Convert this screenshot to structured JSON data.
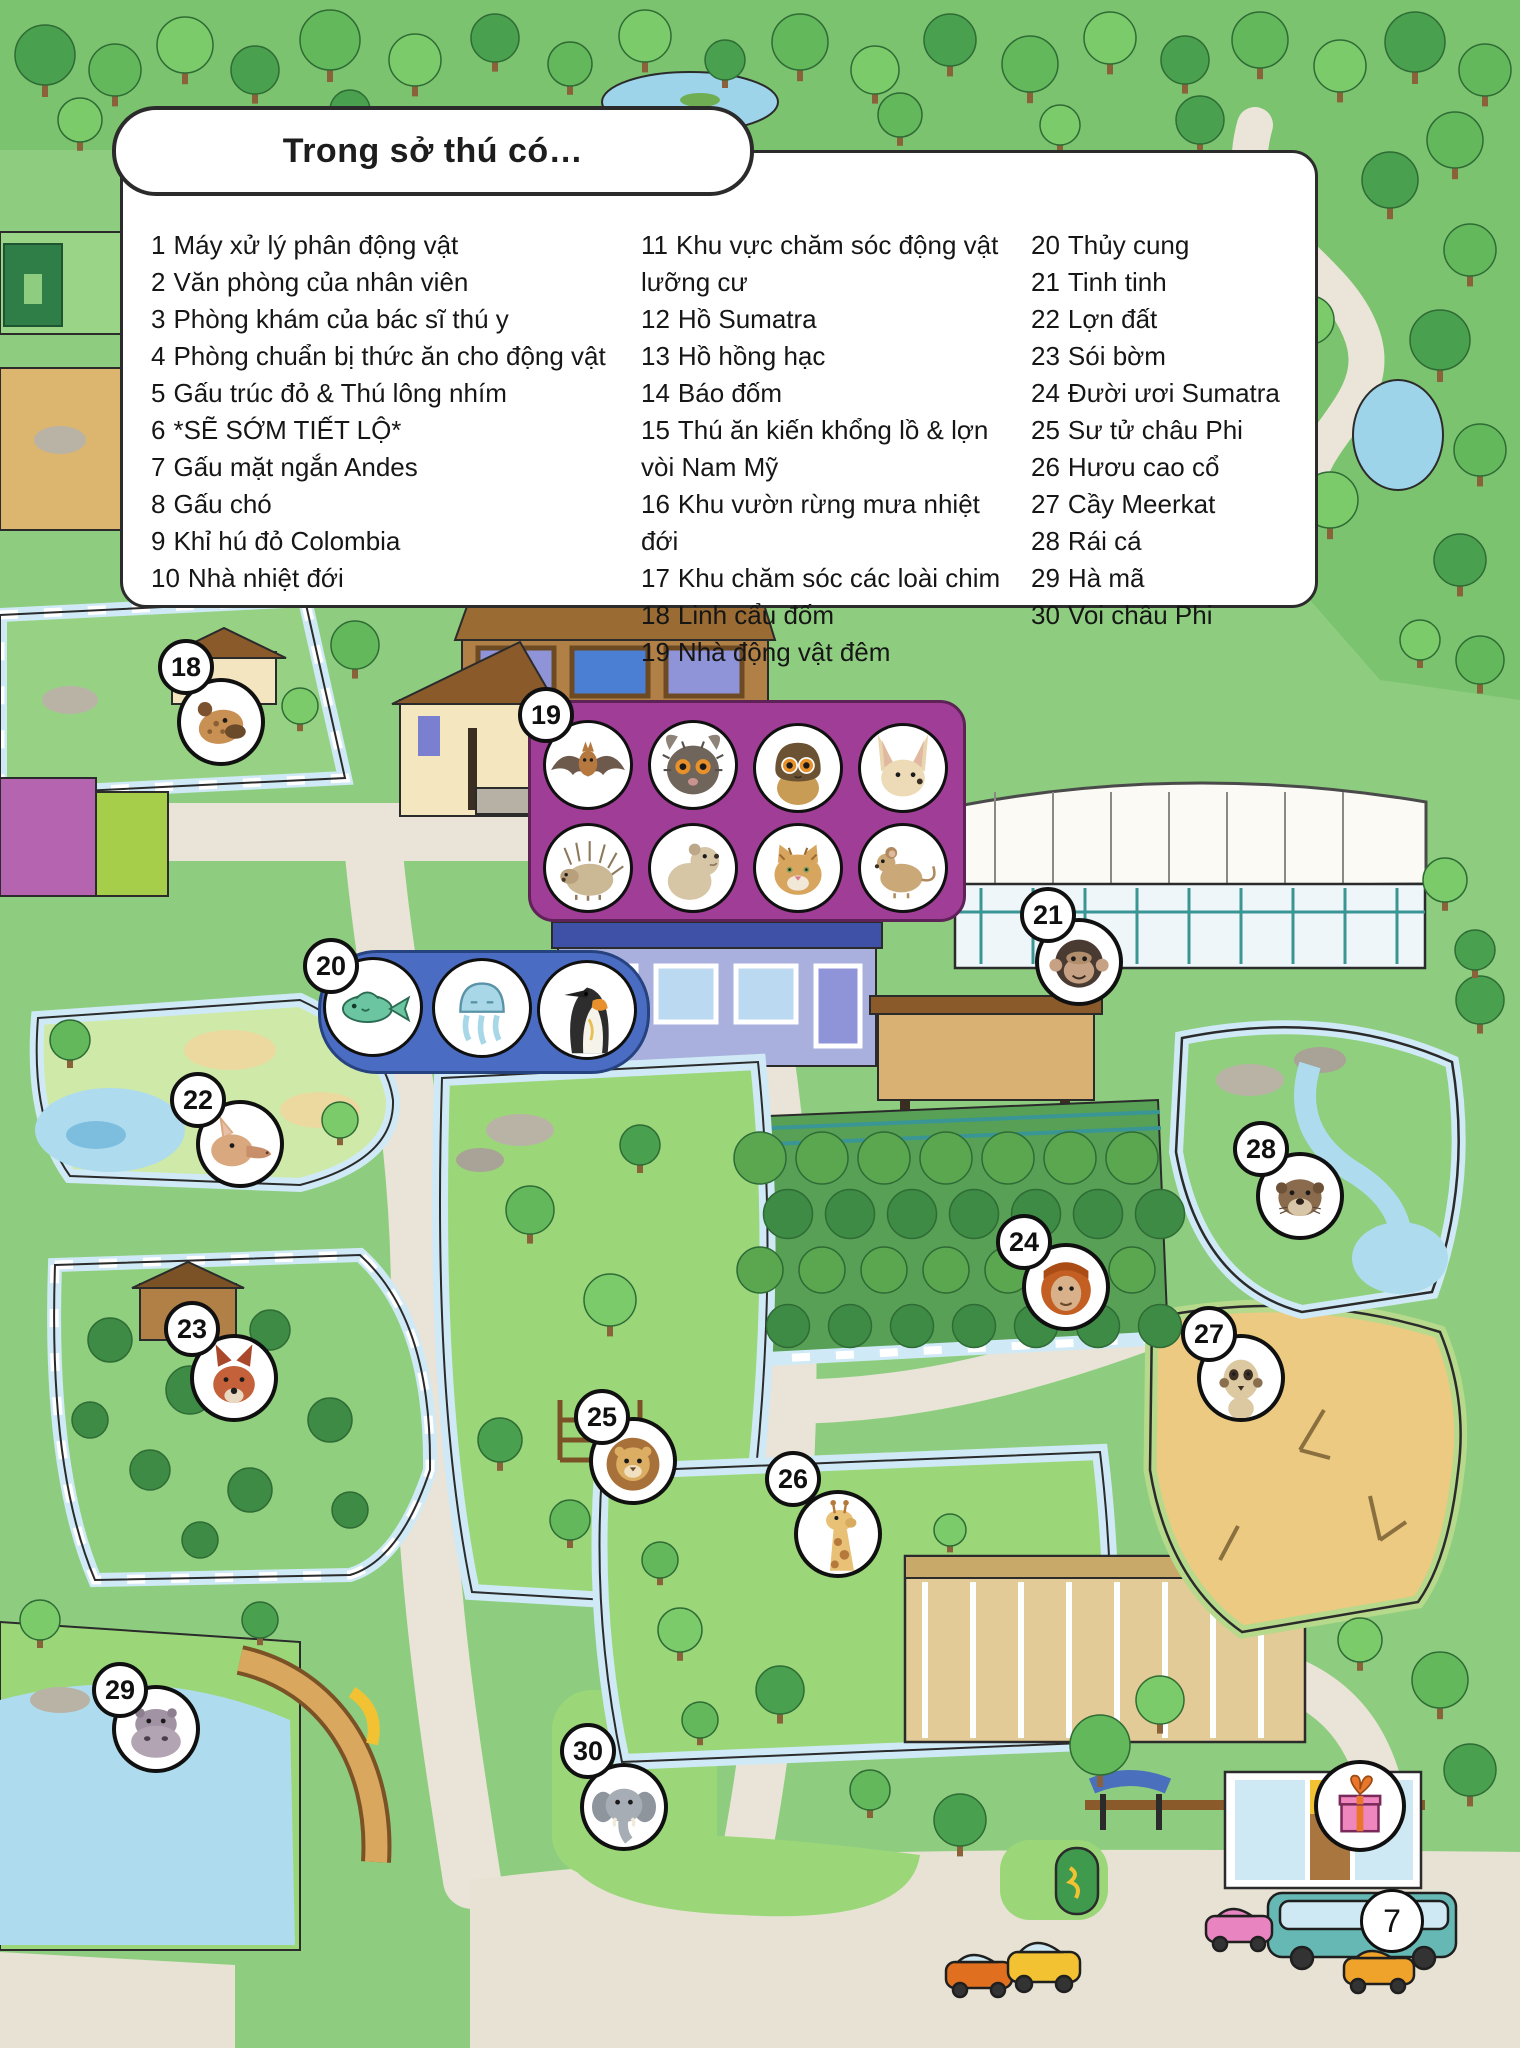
{
  "legend": {
    "title": "Trong sở thú có…",
    "items": [
      {
        "num": "1",
        "label": "Máy xử lý phân động vật"
      },
      {
        "num": "2",
        "label": "Văn phòng của nhân viên"
      },
      {
        "num": "3",
        "label": "Phòng khám của bác sĩ thú y"
      },
      {
        "num": "4",
        "label": "Phòng chuẩn bị thức ăn cho động vật"
      },
      {
        "num": "5",
        "label": "Gấu trúc đỏ & Thú lông nhím"
      },
      {
        "num": "6",
        "label": "*SẼ SỚM TIẾT LỘ*"
      },
      {
        "num": "7",
        "label": "Gấu mặt ngắn Andes"
      },
      {
        "num": "8",
        "label": "Gấu chó"
      },
      {
        "num": "9",
        "label": "Khỉ hú đỏ Colombia"
      },
      {
        "num": "10",
        "label": "Nhà nhiệt đới"
      },
      {
        "num": "11",
        "label": "Khu vực chăm sóc động vật lưỡng cư"
      },
      {
        "num": "12",
        "label": "Hồ Sumatra"
      },
      {
        "num": "13",
        "label": "Hồ hồng hạc"
      },
      {
        "num": "14",
        "label": "Báo đốm"
      },
      {
        "num": "15",
        "label": "Thú ăn kiến khổng lồ & lợn vòi Nam Mỹ"
      },
      {
        "num": "16",
        "label": "Khu vườn rừng mưa nhiệt đới"
      },
      {
        "num": "17",
        "label": "Khu chăm sóc các loài chim"
      },
      {
        "num": "18",
        "label": "Linh cẩu đốm"
      },
      {
        "num": "19",
        "label": "Nhà động vật đêm"
      },
      {
        "num": "20",
        "label": "Thủy cung"
      },
      {
        "num": "21",
        "label": "Tinh tinh"
      },
      {
        "num": "22",
        "label": "Lợn đất"
      },
      {
        "num": "23",
        "label": "Sói bờm"
      },
      {
        "num": "24",
        "label": "Đười ươi Sumatra"
      },
      {
        "num": "25",
        "label": "Sư tử châu Phi"
      },
      {
        "num": "26",
        "label": "Hươu cao cổ"
      },
      {
        "num": "27",
        "label": "Cầy Meerkat"
      },
      {
        "num": "28",
        "label": "Rái cá"
      },
      {
        "num": "29",
        "label": "Hà mã"
      },
      {
        "num": "30",
        "label": "Voi châu Phi"
      }
    ]
  },
  "markers": {
    "18": {
      "number": "18",
      "icon": "spotted-hyena"
    },
    "19": {
      "number": "19"
    },
    "20": {
      "number": "20"
    },
    "21": {
      "number": "21",
      "icon": "chimpanzee"
    },
    "22": {
      "number": "22",
      "icon": "aardvark"
    },
    "23": {
      "number": "23",
      "icon": "maned-wolf"
    },
    "24": {
      "number": "24",
      "icon": "orangutan"
    },
    "25": {
      "number": "25",
      "icon": "lion"
    },
    "26": {
      "number": "26",
      "icon": "giraffe"
    },
    "27": {
      "number": "27",
      "icon": "meerkat"
    },
    "28": {
      "number": "28",
      "icon": "otter"
    },
    "29": {
      "number": "29",
      "icon": "hippo"
    },
    "30": {
      "number": "30",
      "icon": "elephant"
    }
  },
  "nocturnal_house_icons": [
    "bat",
    "aye-aye",
    "night-monkey",
    "fennec-fox",
    "porcupine",
    "kinkajou",
    "wild-cat",
    "mouse"
  ],
  "aquarium_icons": [
    "fish",
    "jellyfish",
    "king-penguin"
  ],
  "gift_icon": "gift",
  "page_number": "7",
  "colors": {
    "grass": "#8ecd7f",
    "path": "#e9e4d7",
    "water": "#aedcee",
    "moat": "#cfeaf6",
    "nocturnal_box": "#a03d96",
    "aquarium_box": "#4a6cc2",
    "sand": "#ecca82"
  }
}
